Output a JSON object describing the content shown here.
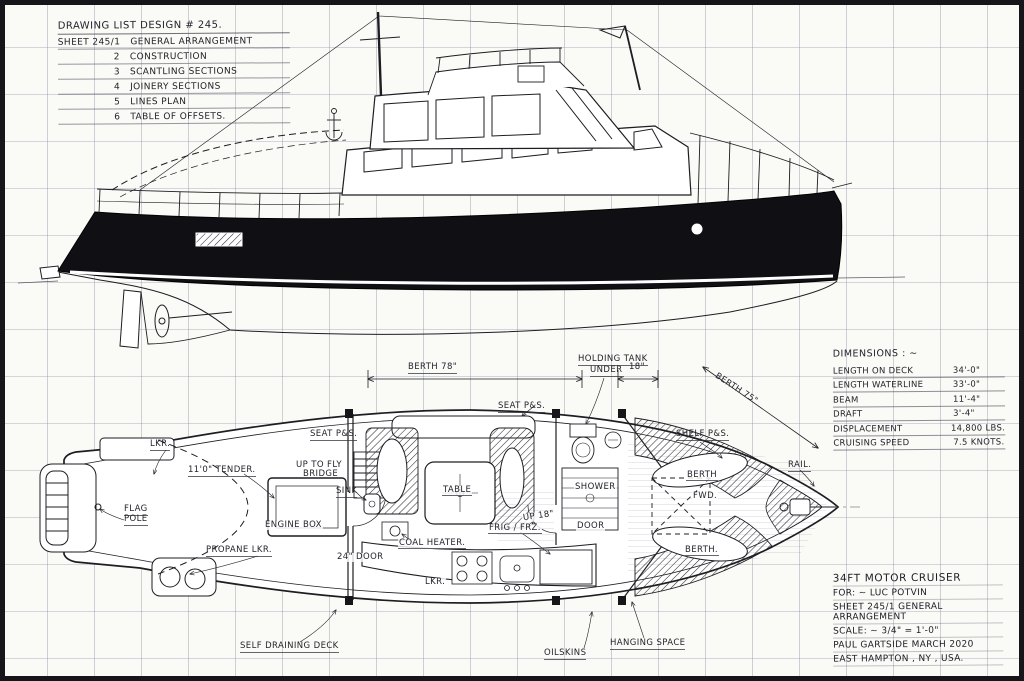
{
  "colors": {
    "ink": "#1d1d22",
    "paper": "#fafaf7",
    "hull_black": "#101014",
    "grid_line": "#7682a0"
  },
  "drawing_list": {
    "title": "DRAWING LIST DESIGN # 245.",
    "items": [
      {
        "num": "SHEET 245/1",
        "label": "GENERAL ARRANGEMENT"
      },
      {
        "num": "2",
        "label": "CONSTRUCTION"
      },
      {
        "num": "3",
        "label": "SCANTLING SECTIONS"
      },
      {
        "num": "4",
        "label": "JOINERY SECTIONS"
      },
      {
        "num": "5",
        "label": "LINES PLAN"
      },
      {
        "num": "6",
        "label": "TABLE OF OFFSETS."
      }
    ]
  },
  "dimensions": {
    "title": "DIMENSIONS : ~",
    "rows": [
      {
        "label": "LENGTH ON DECK",
        "value": "34'-0\""
      },
      {
        "label": "LENGTH WATERLINE",
        "value": "33'-0\""
      },
      {
        "label": "BEAM",
        "value": "11'-4\""
      },
      {
        "label": "DRAFT",
        "value": "3'-4\""
      },
      {
        "label": "DISPLACEMENT",
        "value": "14,800 LBS."
      },
      {
        "label": "CRUISING SPEED",
        "value": "7.5 KNOTS."
      }
    ]
  },
  "title_block": {
    "boat": "34FT MOTOR CRUISER",
    "client": "FOR: ~ LUC POTVIN",
    "sheet": "SHEET 245/1  GENERAL ARRANGEMENT",
    "scale": "SCALE: ~ 3/4\" = 1'-0\"",
    "author_date": "PAUL GARTSIDE      MARCH 2020",
    "place": "EAST HAMPTON , NY ,  USA."
  },
  "plan_labels": {
    "dim_berth_78": "BERTH 78\"",
    "holding_tank_1": "HOLDING TANK",
    "holding_tank_2": "UNDER",
    "dim_18": "18\"",
    "dim_berth_75": "BERTH 75\"",
    "seat_ps_fwd": "SEAT P&S.",
    "seat_ps_aft": "SEAT P&S.",
    "shelf_ps": "SHELF P&S.",
    "locker_aft": "LKR.",
    "tender": "11'0\" TENDER.",
    "up_to_fly_1": "UP TO FLY",
    "up_to_fly_2": "BRIDGE",
    "sink": "SINK",
    "flag_1": "FLAG",
    "flag_2": "POLE",
    "engine_box": "ENGINE BOX",
    "table": "TABLE",
    "shower": "SHOWER",
    "up_18": "UP 18\"",
    "door": "DOOR",
    "berth_stbd": "BERTH",
    "fwd_hatch": "FWD.",
    "berth_port": "BERTH.",
    "rail": "RAIL.",
    "propane": "PROPANE LKR.",
    "door_24": "24\" DOOR",
    "coal_heater": "COAL HEATER.",
    "frig_frz": "FRIG / FRZ.",
    "locker_galley": "LKR.",
    "self_draining_deck": "SELF DRAINING DECK",
    "oilskins": "OILSKINS",
    "hanging_space": "HANGING SPACE"
  }
}
